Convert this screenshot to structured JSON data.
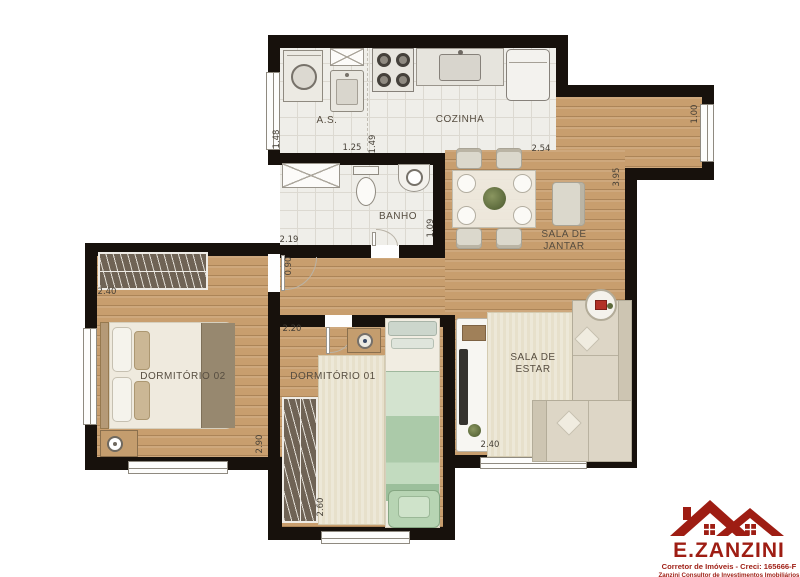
{
  "rooms": {
    "as": "A.S.",
    "cozinha": "COZINHA",
    "banho": "BANHO",
    "jantar_l1": "SALA DE",
    "jantar_l2": "JANTAR",
    "estar_l1": "SALA DE",
    "estar_l2": "ESTAR",
    "dorm2": "DORMITÓRIO 02",
    "dorm1": "DORMITÓRIO 01"
  },
  "dims": {
    "as_h": "1.48",
    "as_w": "1.25",
    "coz_h": "1.49",
    "coz_w": "2.54",
    "varanda_w": "1.00",
    "jantar_h": "3.95",
    "banho_w": "2.19",
    "banho_h": "1.09",
    "porta_dorm2": "0.90",
    "dorm2_w": "2.40",
    "dorm2_h": "2.90",
    "dorm1_w": "2.20",
    "dorm1_h": "2.60",
    "estar_w": "2.40"
  },
  "logo": {
    "brand": "E.ZANZINI",
    "tagline": "Corretor de Imóveis - Creci: 165666-F",
    "subtitle": "Zanzini Consultor de Investimentos Imobiliários"
  },
  "colors": {
    "wall": "#17110c",
    "wood_floor": "#c89e6e",
    "tile_floor": "#efeee9",
    "logo_red": "#9e1d13"
  }
}
